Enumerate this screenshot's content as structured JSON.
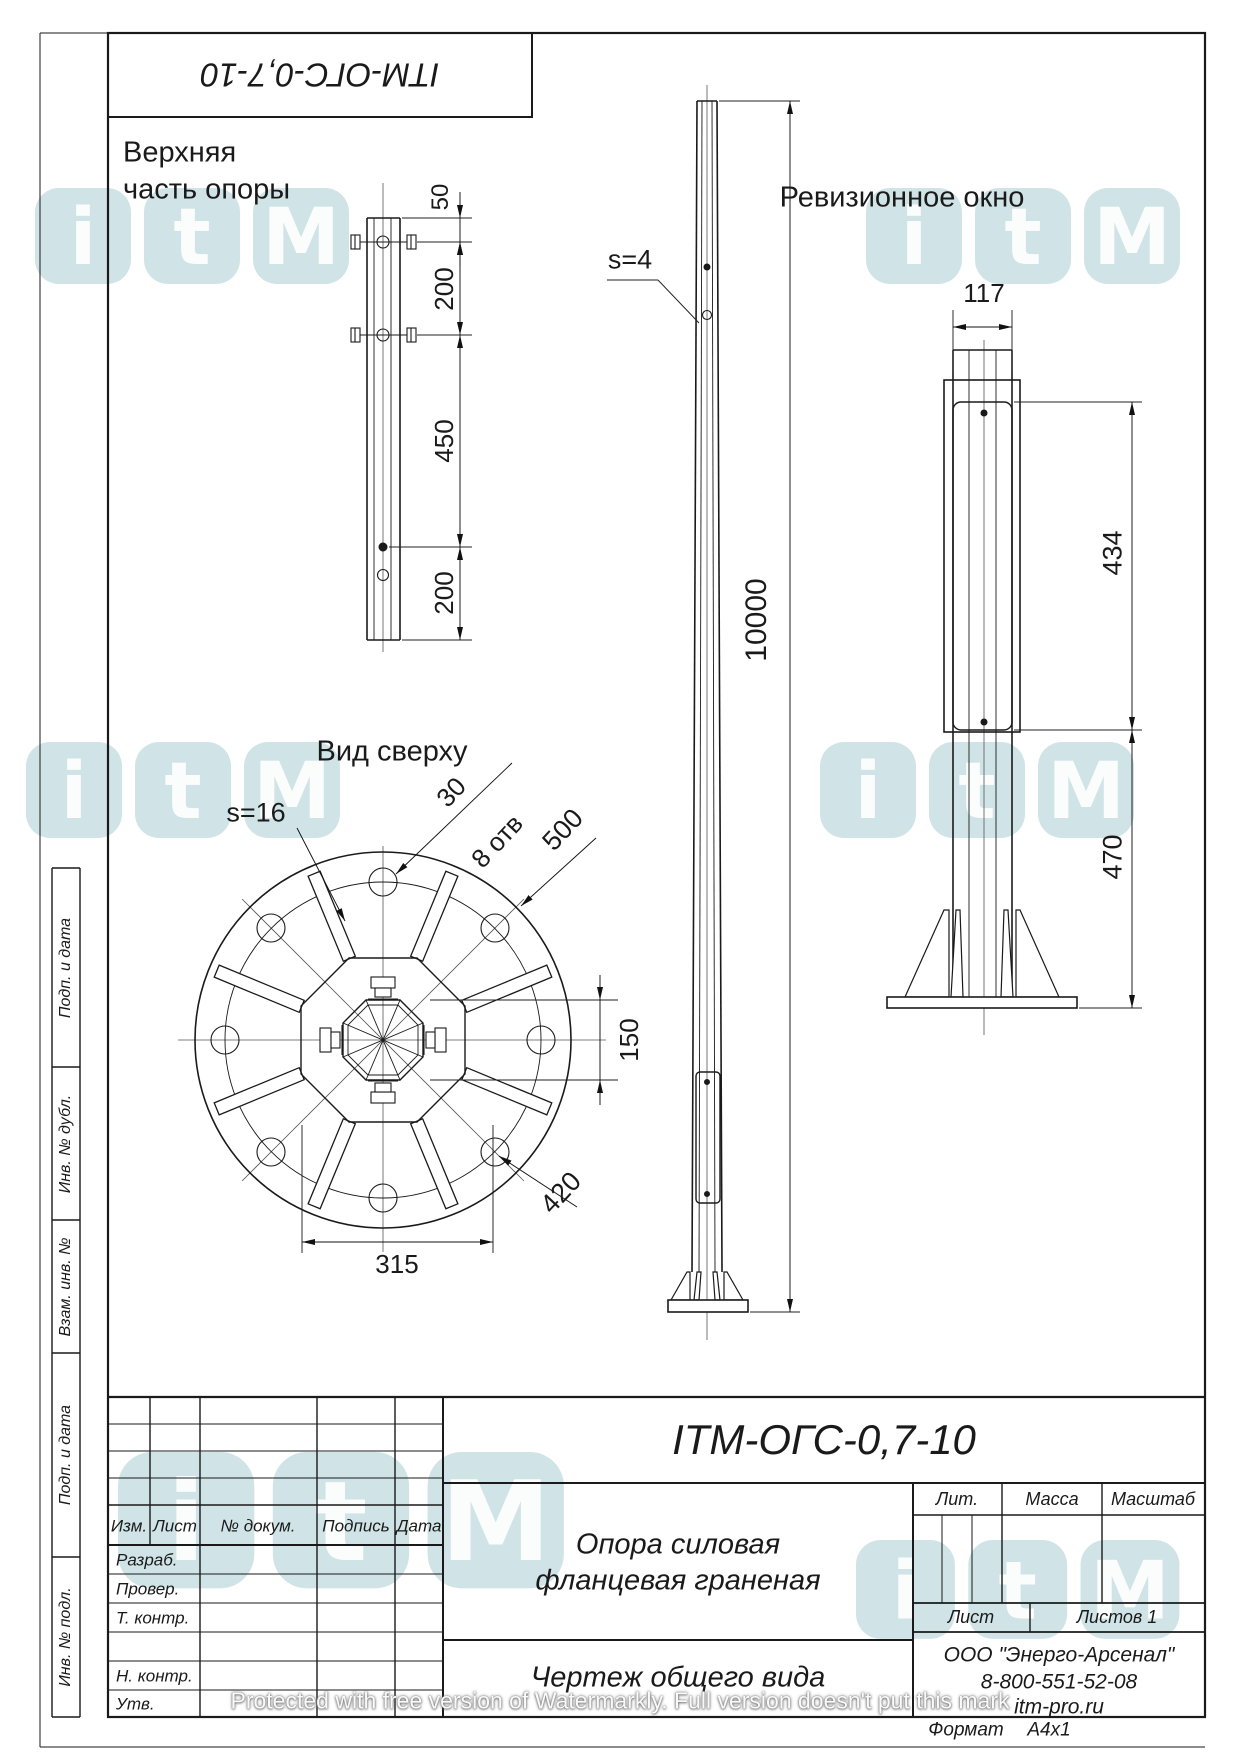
{
  "stamp_top": {
    "designation_flipped": "ITM-ОГС-0,7-10"
  },
  "views": {
    "upper_detail": {
      "title_line1": "Верхняя",
      "title_line2": "часть опоры",
      "dims": {
        "d50": "50",
        "d200a": "200",
        "d450": "450",
        "d200b": "200"
      }
    },
    "main": {
      "wall_label": "s=4",
      "height": "10000"
    },
    "top_view": {
      "title": "Вид сверху",
      "thickness_label": "s=16",
      "hole_dia": "30",
      "holes_count": "8 отв",
      "flange_dia": "500",
      "bolt_circle": "420",
      "across_flats": "150",
      "bolt_span": "315"
    },
    "revision": {
      "title": "Ревизионное окно",
      "width": "117",
      "window_height": "434",
      "bottom_offset": "470"
    }
  },
  "title_block": {
    "designation": "ITM-ОГС-0,7-10",
    "name_line1": "Опора силовая",
    "name_line2": "фланцевая граненая",
    "doc_type": "Чертеж общего вида",
    "company": "ООО \"Энерго-Арсенал\"",
    "phone": "8-800-551-52-08",
    "site": "itm-pro.ru",
    "headers": {
      "izm": "Изм.",
      "list": "Лист",
      "doc": "№ докум.",
      "podp": "Подпись",
      "data": "Дата",
      "lit": "Лит.",
      "massa": "Масса",
      "masshtab": "Масштаб",
      "list2": "Лист",
      "listov": "Листов 1"
    },
    "rows": {
      "razrab": "Разраб.",
      "prover": "Провер.",
      "tkontr": "Т. контр.",
      "nkontr": "Н. контр.",
      "utv": "Утв."
    },
    "format": {
      "label": "Формат",
      "value": "A4x1"
    }
  },
  "side_strip": {
    "cells": [
      "Подп. и дата",
      "Инв. № дубл.",
      "Взам. инв. №",
      "Подп. и дата",
      "Инв. № подл."
    ]
  },
  "watermark": {
    "line1": "itm-pro.ru",
    "line2": "8-800-551-52-08",
    "brand_letters": [
      "i",
      "t",
      "M"
    ],
    "protected_note": "Protected with free version of Watermarkly. Full version doesn't put this mark"
  }
}
